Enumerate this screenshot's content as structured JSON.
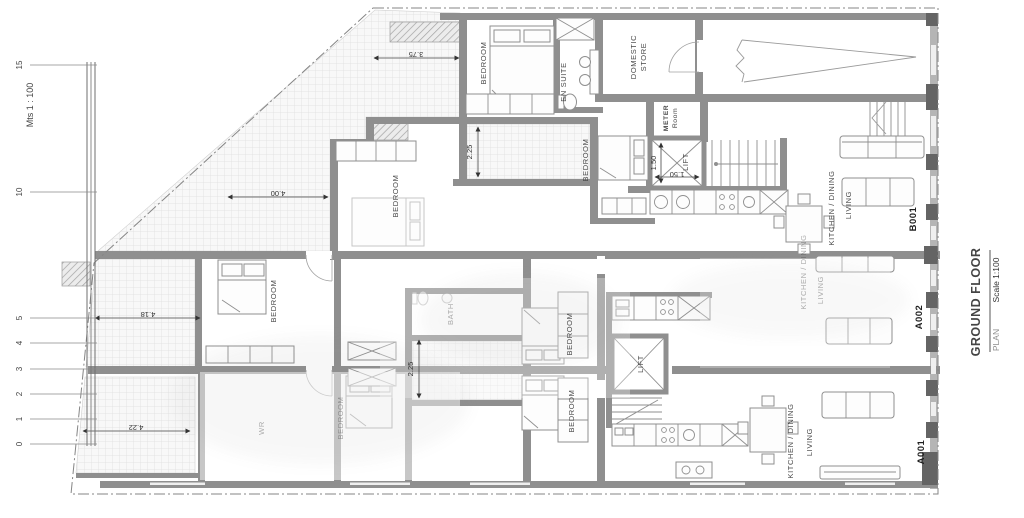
{
  "scalebar": {
    "title": "Mts 1 : 100",
    "ticks": [
      "15",
      "10",
      "5",
      "4",
      "3",
      "2",
      "1",
      "0"
    ]
  },
  "labels": {
    "bedroom": "BEDROOM",
    "en_suite": "EN SUITE",
    "domestic": "DOMESTIC",
    "store": "STORE",
    "meter": "METER",
    "meter_room": "Room",
    "lift": "LIFT",
    "bath": "BATH",
    "wr": "WR",
    "kitchen_dining": "KITCHEN / DINING",
    "living": "LIVING"
  },
  "units": {
    "b001": "B001",
    "a002": "A002",
    "a001": "A001"
  },
  "dims": {
    "d375": "3.75",
    "d400": "4.00",
    "d418": "4.18",
    "d422": "4.22",
    "d225_top": "2.25",
    "d225_court": "2.25",
    "d150_v": "1.50",
    "d150_h": "1.50"
  },
  "titleblock": {
    "project": "GROUND FLOOR",
    "sheet": "PLAN",
    "scale": "Scale 1:100"
  }
}
